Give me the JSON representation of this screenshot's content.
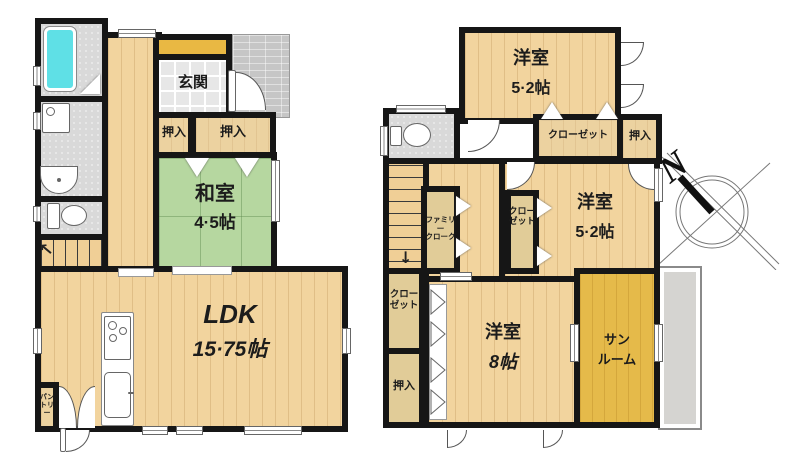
{
  "floor1": {
    "entrance_label": "玄関",
    "closet_small_label": "押入",
    "closet_wide_label": "押入",
    "tatami_room_name": "和室",
    "tatami_room_size": "4·5帖",
    "ldk_name": "LDK",
    "ldk_size": "15·75帖",
    "pantry_line1": "パン",
    "pantry_line2": "トリー",
    "stairs_arrow": "↑"
  },
  "floor2": {
    "bedroom_top_name": "洋室",
    "bedroom_top_size": "5·2帖",
    "closet_top_label": "クローゼット",
    "oshiire_top_label": "押入",
    "bedroom_mid_name": "洋室",
    "bedroom_mid_size": "5·2帖",
    "closet_mid_line1": "クロー",
    "closet_mid_line2": "ゼット",
    "family_closet_line1": "ファミリー",
    "family_closet_line2": "クローク",
    "closet_left_line1": "クロー",
    "closet_left_line2": "ゼット",
    "oshiire_left_label": "押入",
    "bedroom_large_name": "洋室",
    "bedroom_large_size": "8帖",
    "sunroom_line1": "サン",
    "sunroom_line2": "ルーム",
    "stairs_arrow": "↓"
  },
  "compass": {
    "north_label": "N"
  },
  "colors": {
    "wall": "#161616",
    "wood_floor": "#f2d49e",
    "tatami": "#b6d7a0",
    "closet_tan": "#ecd2a0",
    "sunroom_yellow": "#e5ba4a",
    "bathtub_cyan": "#5fe0e6",
    "shoe_cabinet_orange": "#e9b843",
    "tile_gray": "#d9d9d9",
    "porch_gray": "#c6c6c6",
    "balcony_gray": "#d5d4d1"
  }
}
